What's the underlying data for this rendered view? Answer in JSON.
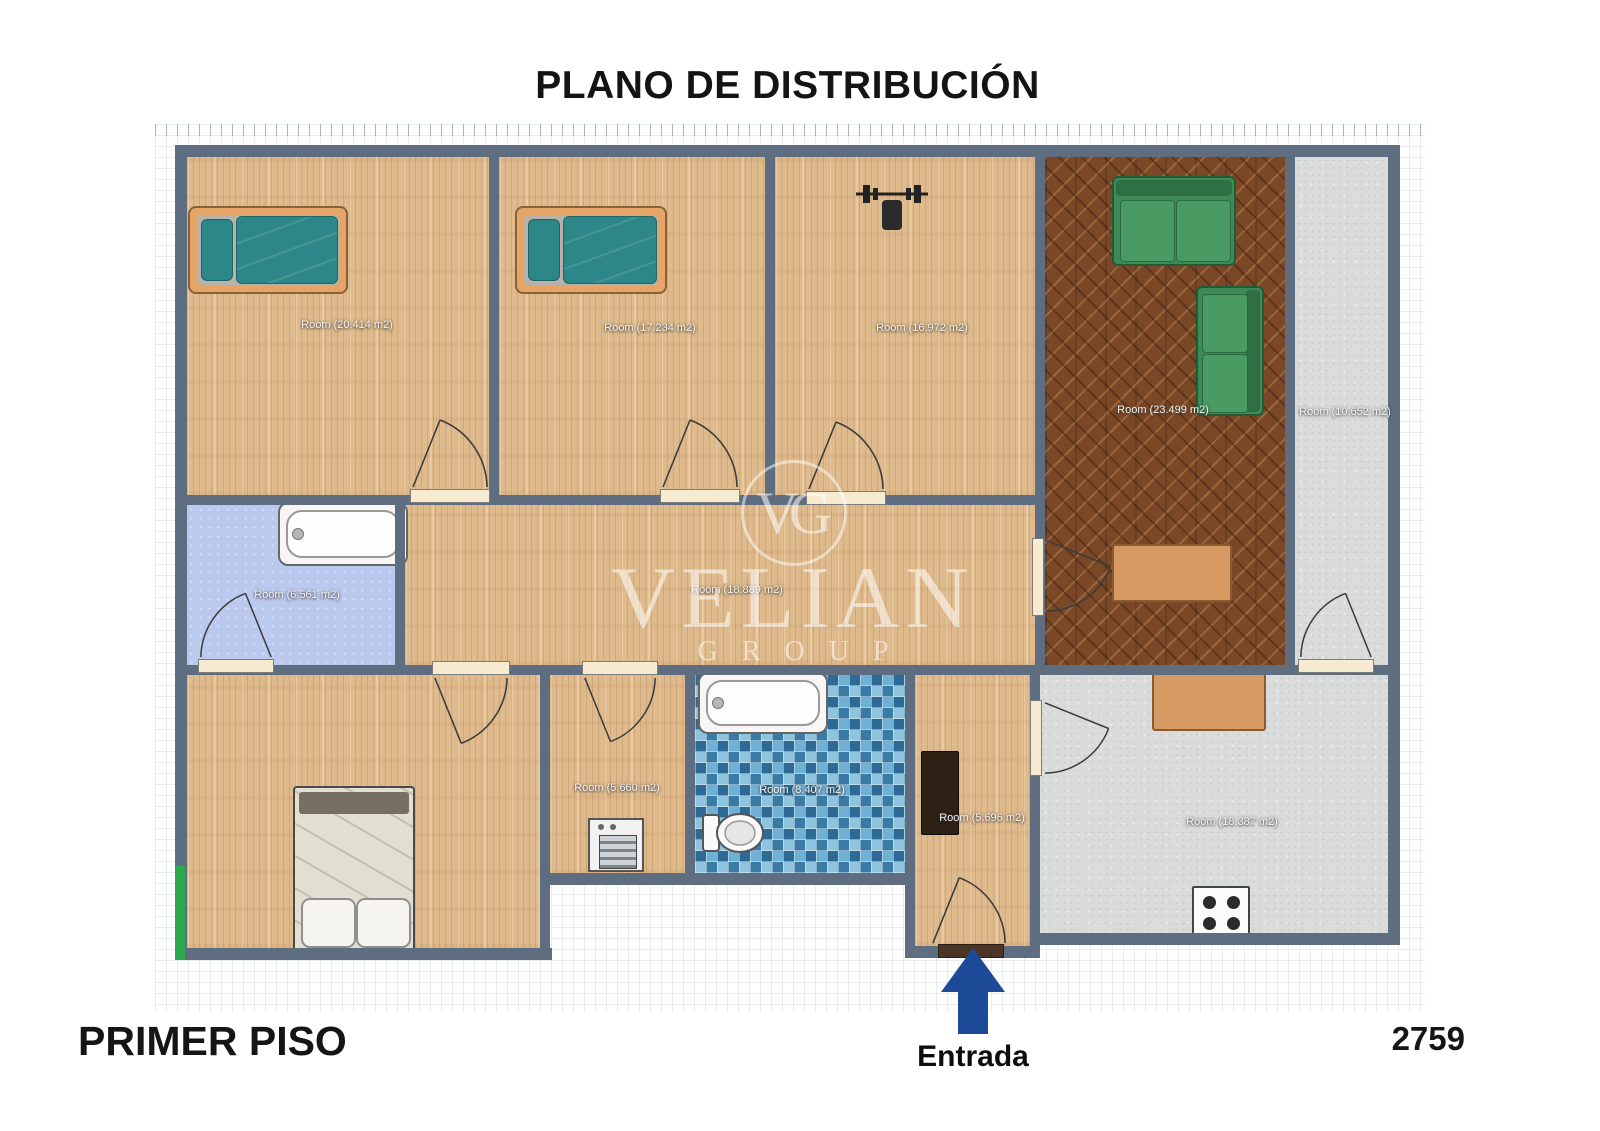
{
  "title": "PLANO DE DISTRIBUCIÓN",
  "floor_label": "PRIMER PISO",
  "plan_number": "2759",
  "entrance_label": "Entrada",
  "watermark": {
    "initials": "VG",
    "name": "VELIAN",
    "subtitle": "GROUP"
  },
  "rooms": [
    {
      "name": "bedroom-1",
      "label": "Room (20.414 m2)"
    },
    {
      "name": "bedroom-2",
      "label": "Room (17.234 m2)"
    },
    {
      "name": "gym-room",
      "label": "Room (16.972 m2)"
    },
    {
      "name": "living-room",
      "label": "Room (23.499 m2)"
    },
    {
      "name": "storage-room",
      "label": "Room (10.652 m2)"
    },
    {
      "name": "bathroom-1",
      "label": "Room (6.561 m2)"
    },
    {
      "name": "hallway",
      "label": "Room (18.889 m2)"
    },
    {
      "name": "laundry-room",
      "label": "Room (5.660 m2)"
    },
    {
      "name": "bathroom-2",
      "label": "Room (8.407 m2)"
    },
    {
      "name": "entry-hall",
      "label": "Room (5.696 m2)"
    },
    {
      "name": "kitchen",
      "label": "Room (18.387 m2)"
    }
  ],
  "colors": {
    "wall": "#5e6e80",
    "entrance_arrow": "#1d4a96",
    "wood_floor": "#dfba8c",
    "parquet_floor": "#7a4827",
    "mosaic_tile": "#4a8cb5",
    "bathroom_floor": "#bcc9ef",
    "concrete_floor": "#dadcdb",
    "sofa_green": "#3e8a57",
    "bed_teal": "#2d8788",
    "bed_frame_orange": "#e6a568",
    "table_orange": "#d79a63",
    "green_accent": "#2ca84e"
  }
}
